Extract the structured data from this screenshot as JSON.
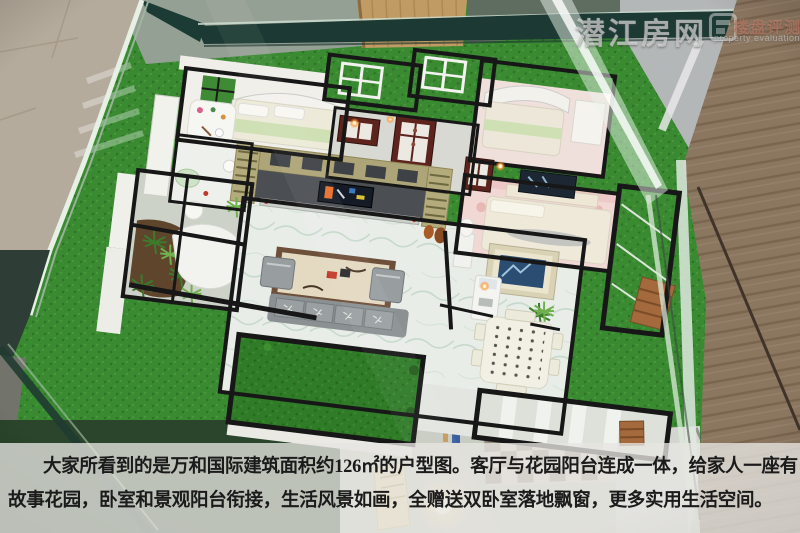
{
  "watermark": {
    "site": "潜江房网",
    "section": "楼盘评测",
    "section_en": "property evaluation"
  },
  "caption": {
    "line1": "大家所看到的是万和国际建筑面积约126㎡的户型图。客厅与花园阳台连成一体，给家人一座有",
    "line2": "故事花园，卧室和景观阳台衔接，生活风景如画，全赠送双卧室落地飘窗，更多实用生活空间。"
  },
  "colors": {
    "watermark_site": "rgba(232,232,232,0.55)",
    "watermark_section": "rgba(196,128,108,0.62)",
    "caption_text": "#1b1b1b",
    "caption_band": "rgba(231,230,225,0.78)",
    "grass_green": "#3a8a32",
    "glass_frame_teal": "#1c3a33",
    "wood_panel_brown": "#8b7660",
    "mahogany_door": "#5c241d",
    "tv_wall_khaki": "#b0a878"
  }
}
